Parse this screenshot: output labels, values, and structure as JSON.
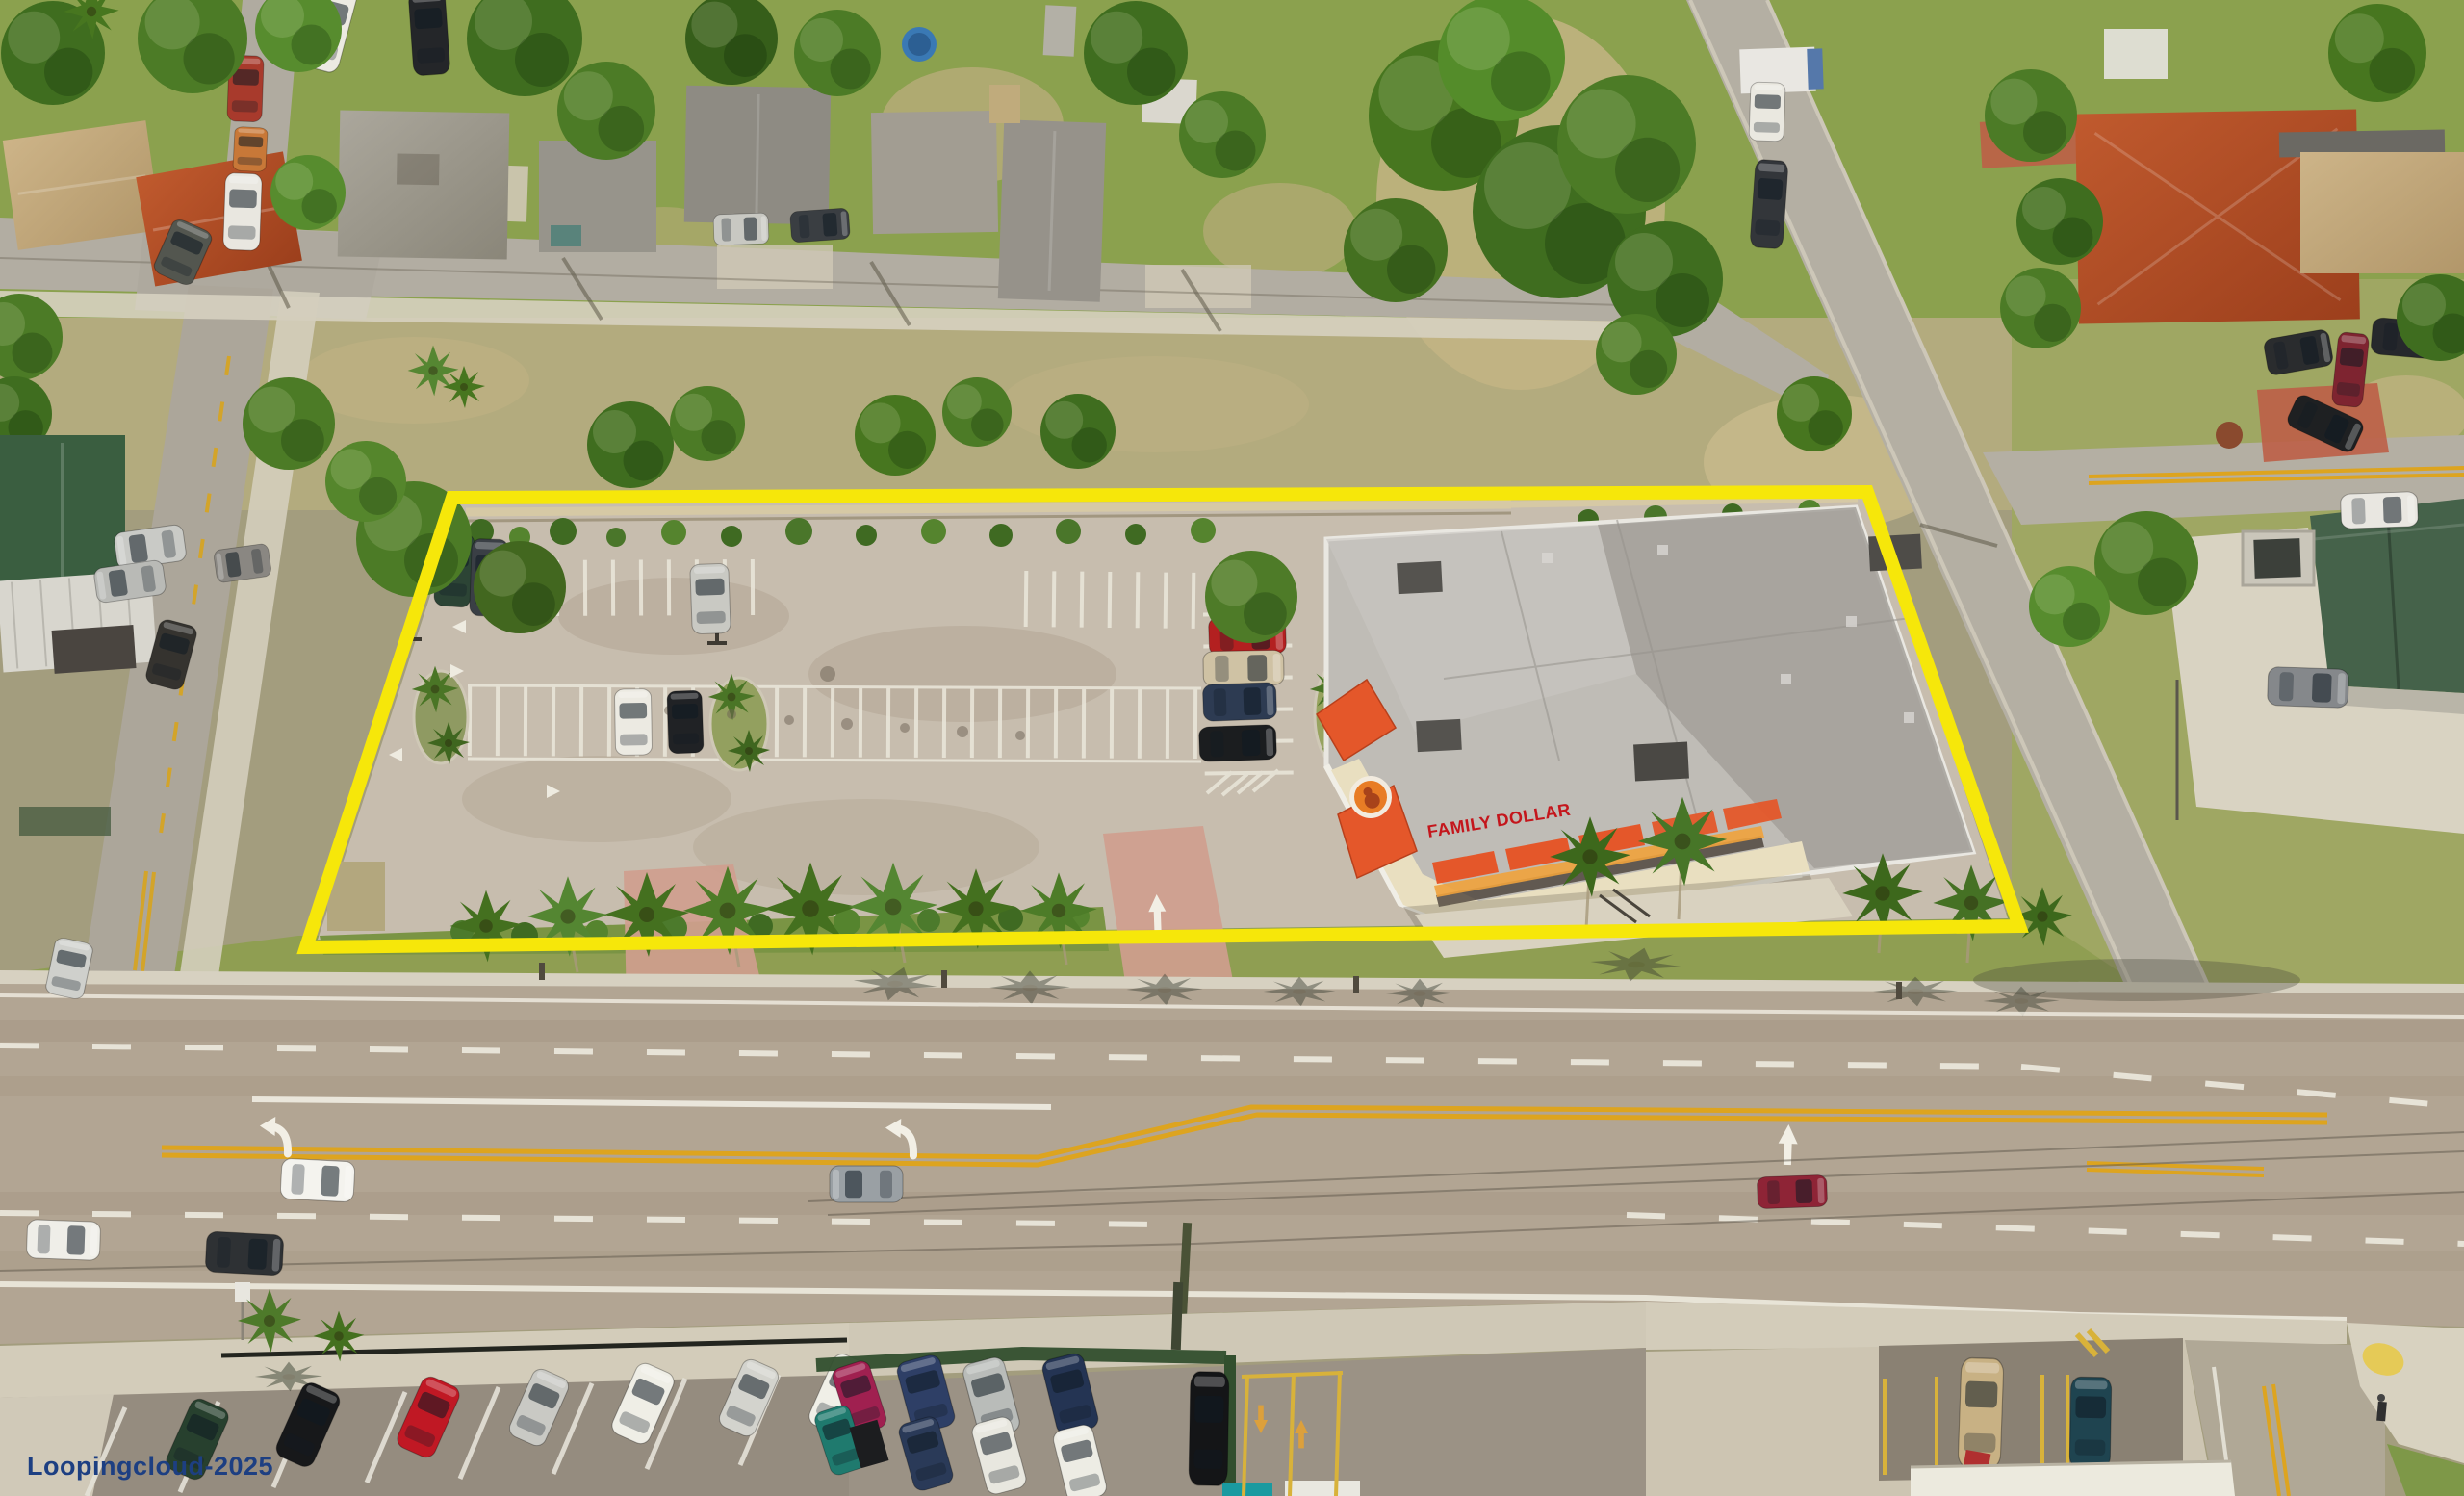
{
  "watermark": {
    "text": "Loopingcloud-2025",
    "color": "#1d3f82"
  },
  "store": {
    "sign_text": "FAMILY DOLLAR",
    "sign_color": "#c4161c",
    "awning_color": "#e4572a",
    "logo_color": "#e87c25"
  },
  "boundary": {
    "color": "#f6e70a"
  }
}
